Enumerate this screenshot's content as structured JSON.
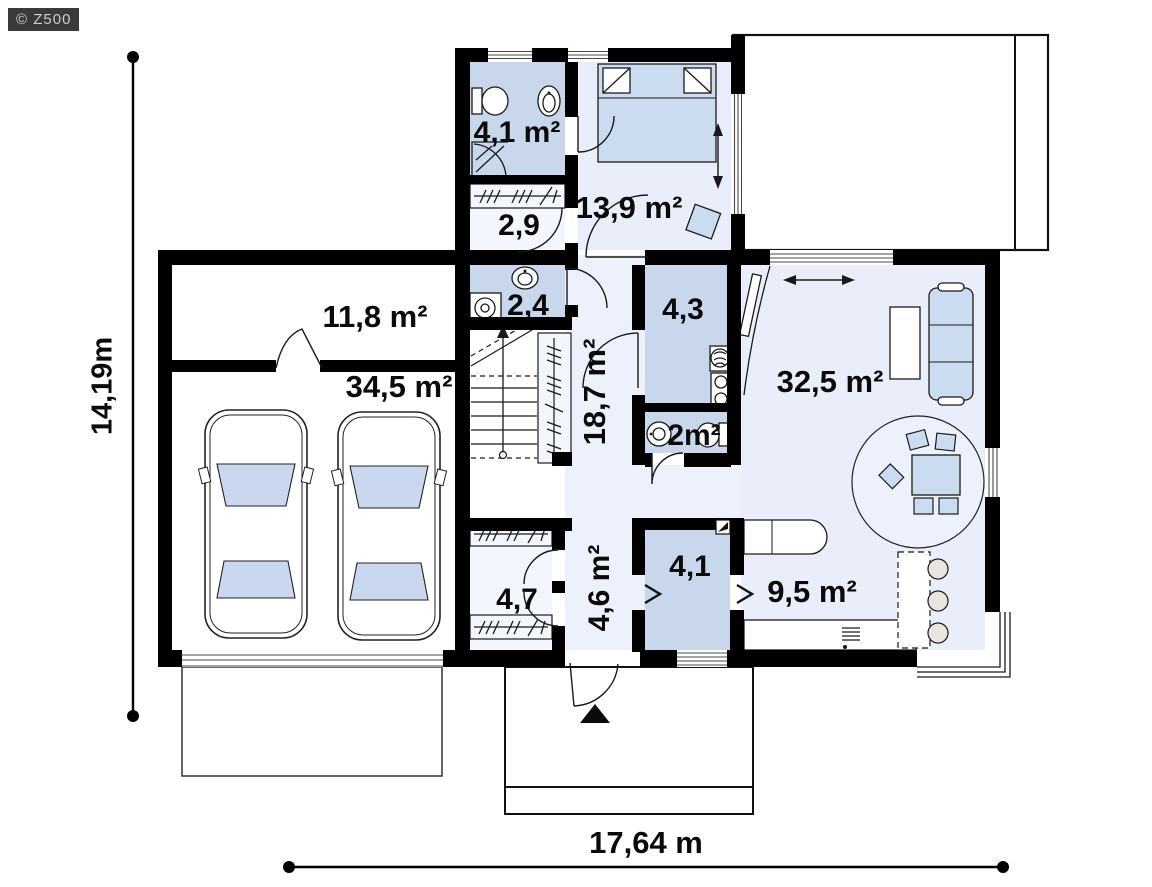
{
  "watermark": "© Z500",
  "dimensions": {
    "height_label": "14,19m",
    "width_label": "17,64 m"
  },
  "rooms": [
    {
      "id": "bathroom",
      "area_label": "4,1 m²"
    },
    {
      "id": "wardrobe-upper",
      "area_label": "2,9"
    },
    {
      "id": "bedroom",
      "area_label": "13,9 m²"
    },
    {
      "id": "laundry",
      "area_label": "2,4"
    },
    {
      "id": "storage-above-garage",
      "area_label": "11,8 m²"
    },
    {
      "id": "garage",
      "area_label": "34,5 m²"
    },
    {
      "id": "utility",
      "area_label": "4,3"
    },
    {
      "id": "hall",
      "area_label": "18,7 m²"
    },
    {
      "id": "wc",
      "area_label": "2m²"
    },
    {
      "id": "living-room",
      "area_label": "32,5 m²"
    },
    {
      "id": "closet-lower",
      "area_label": "4,7"
    },
    {
      "id": "entry",
      "area_label": "4,6 m²"
    },
    {
      "id": "pantry",
      "area_label": "4,1"
    },
    {
      "id": "kitchen",
      "area_label": "9,5 m²"
    }
  ],
  "colors": {
    "wall": "#000000",
    "room_dark": "#c9d7ec",
    "room_medium": "#d7e2f3",
    "room_light": "#e9eefa",
    "room_pale": "#f3f6fc",
    "furniture_blue": "#ccdcf0",
    "watermark_bg": "#3a3a3a",
    "watermark_text": "#cdcdcd"
  }
}
